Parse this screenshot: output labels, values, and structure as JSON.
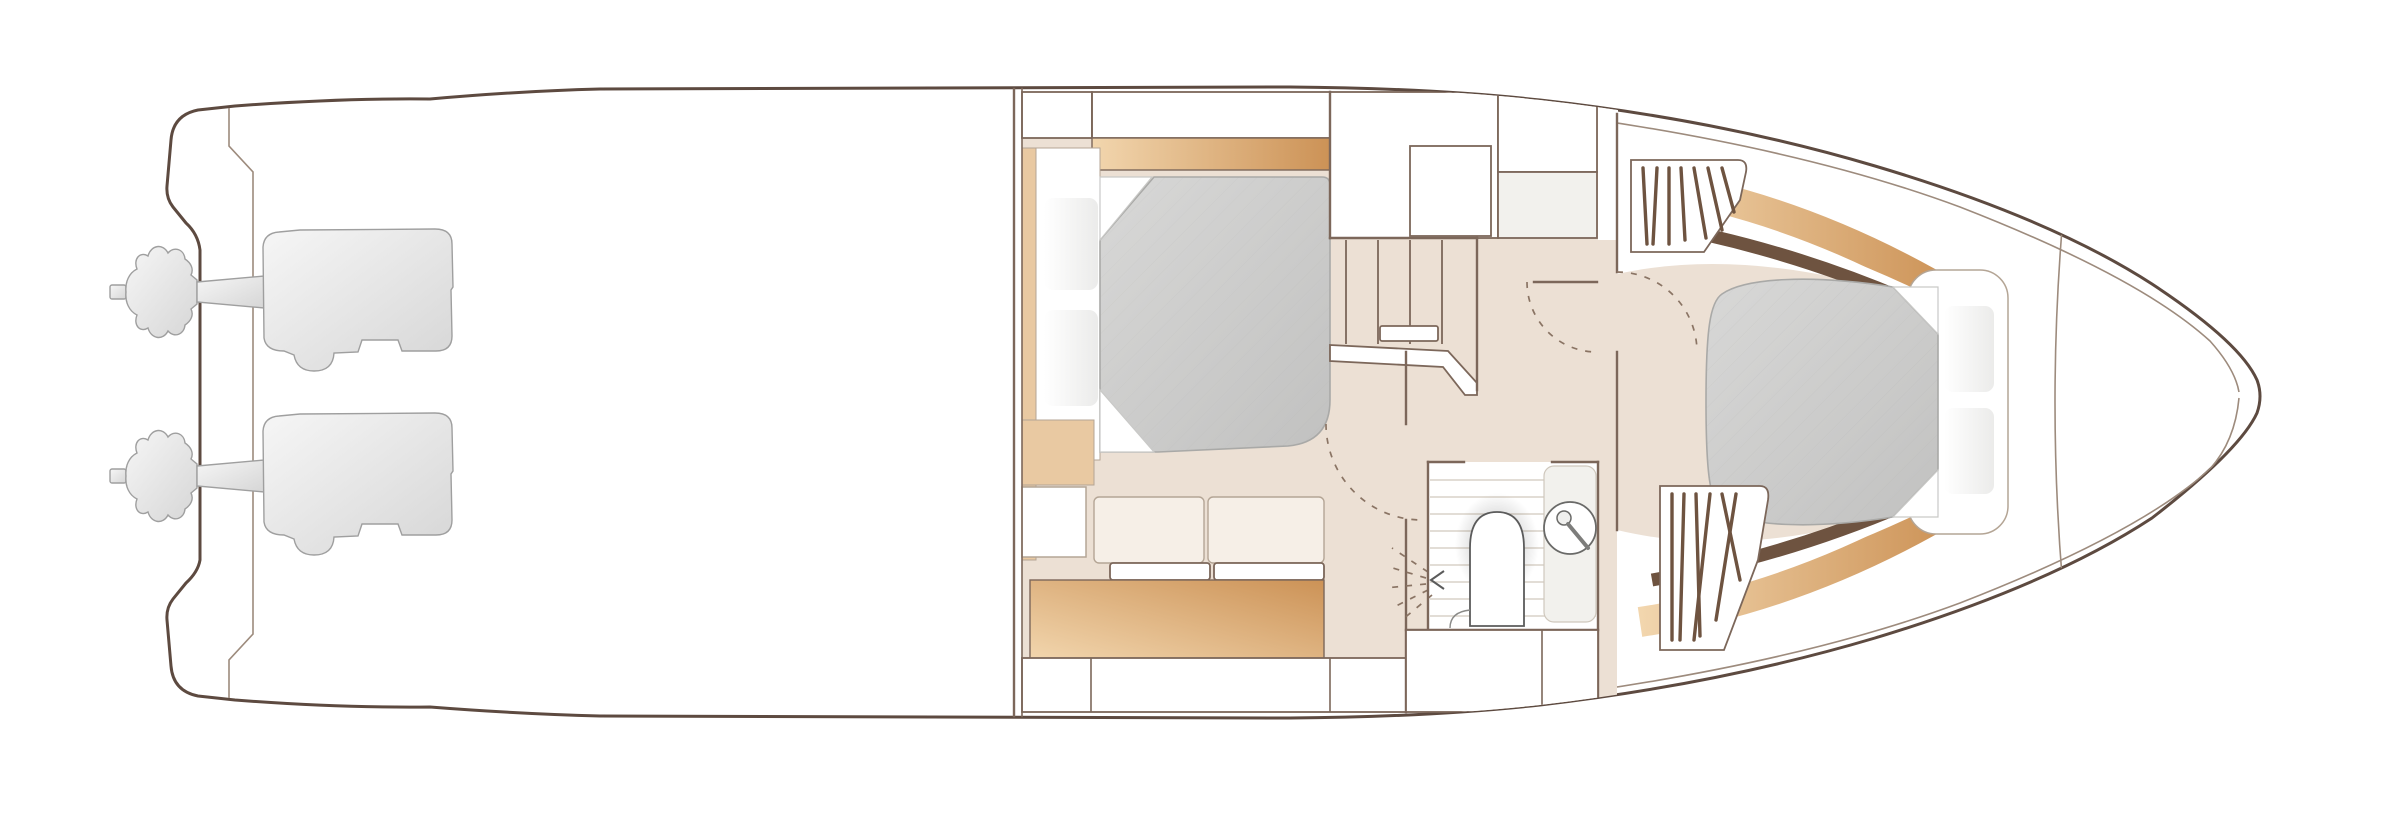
{
  "meta": {
    "title": "Yacht lower deck floor plan",
    "view": "top-down floor plan",
    "orientation": "bow pointing right, stern with engines at left",
    "visible_text": []
  },
  "colors": {
    "hull_line": "#5d4a40",
    "wall_line": "#7c675a",
    "thin_line": "#9d8b7d",
    "furniture_line": "#b4a595",
    "floor": "#ece0d4",
    "plank_line": "#d9d2c8",
    "dash_line": "#8a7464",
    "tan_light": "#f2d6ae",
    "tan_dark": "#cc9256",
    "tan_flat": "#e9c9a2",
    "wood_dark": "#6e5340",
    "bed_gray_light": "#d8d8d7",
    "bed_gray_dark": "#c1c1c0",
    "cushion_cream": "#f6efe7",
    "cream_col": "#f3ece3",
    "counter_gray": "#f2f1ed",
    "engine_light": "#f6f6f6",
    "engine_dark": "#d6d6d6",
    "engine_edge": "#9f9f9f",
    "white": "#ffffff"
  },
  "sections": {
    "stern": {
      "name": "stern and swim platform",
      "engines": {
        "count": 2,
        "items": [
          "port-engine",
          "starboard-engine"
        ],
        "style": "gray silhouette with propeller"
      }
    },
    "aft_deck": {
      "name": "open aft deck / cockpit",
      "content": "empty on lower-deck plan"
    },
    "mid_cabin": {
      "name": "mid cabin",
      "fixtures": [
        "double-bed",
        "pillows x2",
        "headboard-shelf-tan",
        "overhead-cabinets",
        "sofa 2-cushions",
        "seat-rail",
        "storage-chest-tan",
        "aft-lockers"
      ]
    },
    "companionway": {
      "name": "companionway and corridor",
      "stair_steps": 5,
      "fixtures": [
        "stair-treads",
        "handrail",
        "side-rail"
      ],
      "door_swings": 4
    },
    "bathroom": {
      "name": "bathroom / heads",
      "fixtures": [
        "shower-head-with-spray",
        "toilet",
        "round-washbasin-with-faucet",
        "plank-floor",
        "under-counter-lockers"
      ]
    },
    "wardrobes": {
      "count": 2,
      "items": [
        "hanging-wardrobe-upper",
        "hanging-wardrobe-lower"
      ],
      "symbol": "hatched box"
    },
    "forward_cabin": {
      "name": "forward cabin",
      "fixtures": [
        "island-double-bed",
        "pillows x2",
        "curved-headboard",
        "hull-side-shelves-tan",
        "dark-wood-trim"
      ]
    },
    "bow": {
      "name": "bow / forepeak",
      "fixtures": [
        "deck-seam-lines",
        "anchor-locker-chord"
      ]
    }
  }
}
